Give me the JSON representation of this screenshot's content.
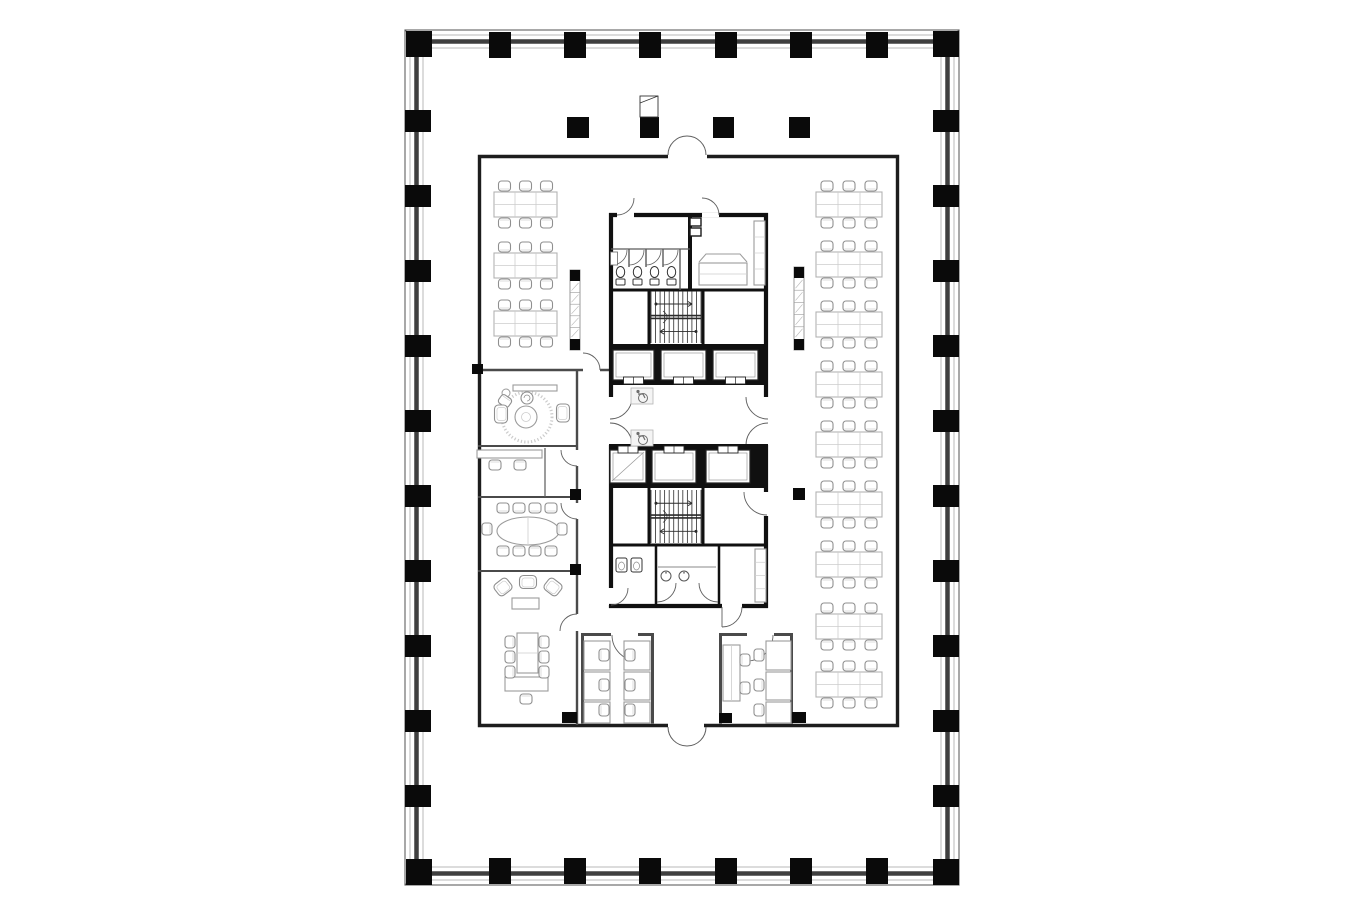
{
  "figure": {
    "type": "architectural-floor-plan",
    "canvas": {
      "w": 1360,
      "h": 900
    },
    "background": "#ffffff"
  },
  "colors": {
    "column": "#0a0a0a",
    "shell_line": "#6f6f6f",
    "shell_line_light": "#a9a9a9",
    "shell_band": "#3f3f3f",
    "office_wall": "#1d1d1d",
    "room_wall": "#4a4a4a",
    "core_wall": "#101010",
    "partition": "#5a5a5a",
    "furniture": "#9b9b9b",
    "furniture_light": "#cdcdcd",
    "chair": "#8f8f8f",
    "door": "#5f5f5f",
    "hatch": "#9a9a9a",
    "rug": "#cccccc",
    "accessible_box_border": "#b5b5b5",
    "accessible_glyph": "#6e6e6e",
    "stair_line": "#2b2b2b"
  },
  "icons": {
    "accessible": "wheelchair-symbol",
    "stair_direction": "arrow",
    "toilet": "toilet-symbol",
    "urinal": "urinal-symbol",
    "sink": "sink-symbol"
  },
  "shell": {
    "outer": {
      "x": 405,
      "y": 30,
      "w": 554,
      "h": 855
    },
    "column_size": {
      "w": 22,
      "h": 26
    },
    "corner_size": 26,
    "top_columns_x": [
      500,
      575,
      650,
      726,
      801,
      877
    ],
    "bottom_columns_x": [
      500,
      575,
      650,
      726,
      801,
      877
    ],
    "left_columns_y": [
      121,
      196,
      271,
      346,
      421,
      496,
      571,
      646,
      721,
      796
    ],
    "right_columns_y": [
      121,
      196,
      271,
      346,
      421,
      496,
      571,
      646,
      721,
      796
    ],
    "corners": [
      [
        406,
        31
      ],
      [
        933,
        31
      ],
      [
        406,
        859
      ],
      [
        933,
        859
      ]
    ]
  },
  "interior_columns": [
    [
      567,
      117,
      22,
      21
    ],
    [
      640,
      117,
      19,
      21
    ],
    [
      713,
      117,
      21,
      21
    ],
    [
      789,
      117,
      21,
      21
    ]
  ],
  "paper_icon": {
    "x": 640,
    "y": 96,
    "w": 18,
    "h": 21
  },
  "free_blocks": [
    [
      793,
      488,
      12,
      12
    ],
    [
      570,
      489,
      11,
      11
    ],
    [
      570,
      564,
      11,
      11
    ],
    [
      472,
      364,
      11,
      10
    ],
    [
      562,
      712,
      15,
      11
    ],
    [
      719,
      713,
      13,
      10
    ],
    [
      792,
      712,
      14,
      11
    ]
  ],
  "shelf_strips": [
    {
      "x": 570,
      "y": 270,
      "w": 10,
      "h": 80
    },
    {
      "x": 794,
      "y": 267,
      "w": 10,
      "h": 83
    }
  ],
  "desk_zones": {
    "chair": {
      "w": 12,
      "h": 10
    },
    "left": {
      "x": 494,
      "desk_w": 63,
      "desk_h": 25,
      "cols": 3,
      "rows_y": [
        192,
        253,
        311
      ]
    },
    "right": {
      "x": 816,
      "desk_w": 66,
      "desk_h": 25,
      "cols": 3,
      "rows_y": [
        192,
        252,
        312,
        372,
        432,
        492,
        552,
        614,
        672
      ]
    }
  },
  "rooms": [
    {
      "name": "open-office-west"
    },
    {
      "name": "open-office-east"
    },
    {
      "name": "lounge"
    },
    {
      "name": "team-room"
    },
    {
      "name": "conference-room"
    },
    {
      "name": "executive-office"
    },
    {
      "name": "office-south-a"
    },
    {
      "name": "office-south-b"
    },
    {
      "name": "restroom-north"
    },
    {
      "name": "amenity-room"
    },
    {
      "name": "stair-north"
    },
    {
      "name": "elevator-bank-north"
    },
    {
      "name": "elevator-lobby"
    },
    {
      "name": "elevator-bank-south"
    },
    {
      "name": "stair-south"
    },
    {
      "name": "restroom-south"
    }
  ],
  "core": {
    "stairs": [
      {
        "x": 651,
        "y": 291,
        "w": 50,
        "h": 52
      },
      {
        "x": 651,
        "y": 490,
        "w": 50,
        "h": 53
      }
    ],
    "elevators_north": {
      "cars": [
        [
          613,
          350,
          41,
          30
        ],
        [
          661,
          350,
          45,
          30
        ],
        [
          713,
          350,
          45,
          30
        ]
      ],
      "door_edge": "bottom"
    },
    "elevators_south": {
      "cars": [
        [
          610,
          450,
          36,
          33
        ],
        [
          652,
          450,
          44,
          33
        ],
        [
          706,
          450,
          44,
          33
        ]
      ],
      "service_car": 0,
      "door_edge": "top"
    },
    "toilets": {
      "y": 272,
      "cx": [
        620.5,
        637.5,
        654.5,
        671.5
      ]
    },
    "urinals": [
      [
        616,
        558
      ],
      [
        631,
        558
      ]
    ],
    "sinks": [
      [
        666,
        576
      ],
      [
        684,
        576
      ]
    ],
    "accessible_markers": [
      [
        631,
        388
      ],
      [
        631,
        430
      ]
    ]
  },
  "furniture": {
    "tables": [
      [
        513,
        385,
        44,
        6,
        ""
      ],
      [
        477,
        450,
        65,
        8,
        ""
      ],
      [
        512,
        598,
        27,
        11,
        ""
      ],
      [
        517,
        633,
        21,
        40,
        "h"
      ],
      [
        505,
        677,
        43,
        14,
        ""
      ],
      [
        584,
        641,
        26,
        29,
        ""
      ],
      [
        584,
        672,
        26,
        28,
        ""
      ],
      [
        584,
        702,
        26,
        21,
        ""
      ],
      [
        624,
        641,
        26,
        29,
        ""
      ],
      [
        624,
        672,
        26,
        28,
        ""
      ],
      [
        624,
        702,
        26,
        21,
        ""
      ],
      [
        723,
        645,
        17,
        56,
        "v"
      ],
      [
        766,
        641,
        25,
        29,
        ""
      ],
      [
        766,
        672,
        25,
        28,
        ""
      ],
      [
        766,
        702,
        25,
        21,
        ""
      ],
      [
        699,
        263,
        48,
        22,
        "h"
      ],
      [
        754,
        221,
        11,
        64,
        "s3"
      ],
      [
        755,
        549,
        11,
        53,
        "s3"
      ]
    ],
    "chairs": [
      [
        503,
        508,
        0
      ],
      [
        519,
        508,
        0
      ],
      [
        535,
        508,
        0
      ],
      [
        551,
        508,
        0
      ],
      [
        503,
        551,
        180
      ],
      [
        519,
        551,
        180
      ],
      [
        535,
        551,
        180
      ],
      [
        551,
        551,
        180
      ],
      [
        487,
        529,
        270
      ],
      [
        562,
        529,
        90
      ],
      [
        495,
        465,
        180
      ],
      [
        520,
        465,
        180
      ],
      [
        510,
        642,
        270
      ],
      [
        510,
        657,
        270
      ],
      [
        510,
        672,
        270
      ],
      [
        544,
        642,
        90
      ],
      [
        544,
        657,
        90
      ],
      [
        544,
        672,
        90
      ],
      [
        526,
        699,
        180
      ],
      [
        604,
        655,
        90
      ],
      [
        604,
        685,
        90
      ],
      [
        604,
        710,
        90
      ],
      [
        630,
        655,
        270
      ],
      [
        630,
        685,
        270
      ],
      [
        630,
        710,
        270
      ],
      [
        745,
        660,
        90
      ],
      [
        745,
        688,
        90
      ],
      [
        759,
        655,
        270
      ],
      [
        759,
        685,
        270
      ],
      [
        759,
        710,
        270
      ],
      [
        505,
        401,
        215
      ]
    ],
    "armchairs": [
      [
        501,
        414,
        270,
        18,
        13
      ],
      [
        563,
        413,
        90,
        18,
        13
      ],
      [
        503,
        587,
        -38,
        16,
        14
      ],
      [
        528,
        582,
        0,
        17,
        13
      ],
      [
        553,
        587,
        38,
        16,
        14
      ]
    ],
    "lounge": {
      "rug": [
        527,
        417,
        25
      ],
      "table": [
        526,
        417,
        11,
        4.5
      ],
      "side_circle": [
        506,
        393,
        4
      ],
      "office_chair": [
        527,
        398,
        6
      ]
    },
    "conference_table": {
      "cx": 528,
      "cy": 531,
      "rx": 31,
      "ry": 14
    }
  }
}
